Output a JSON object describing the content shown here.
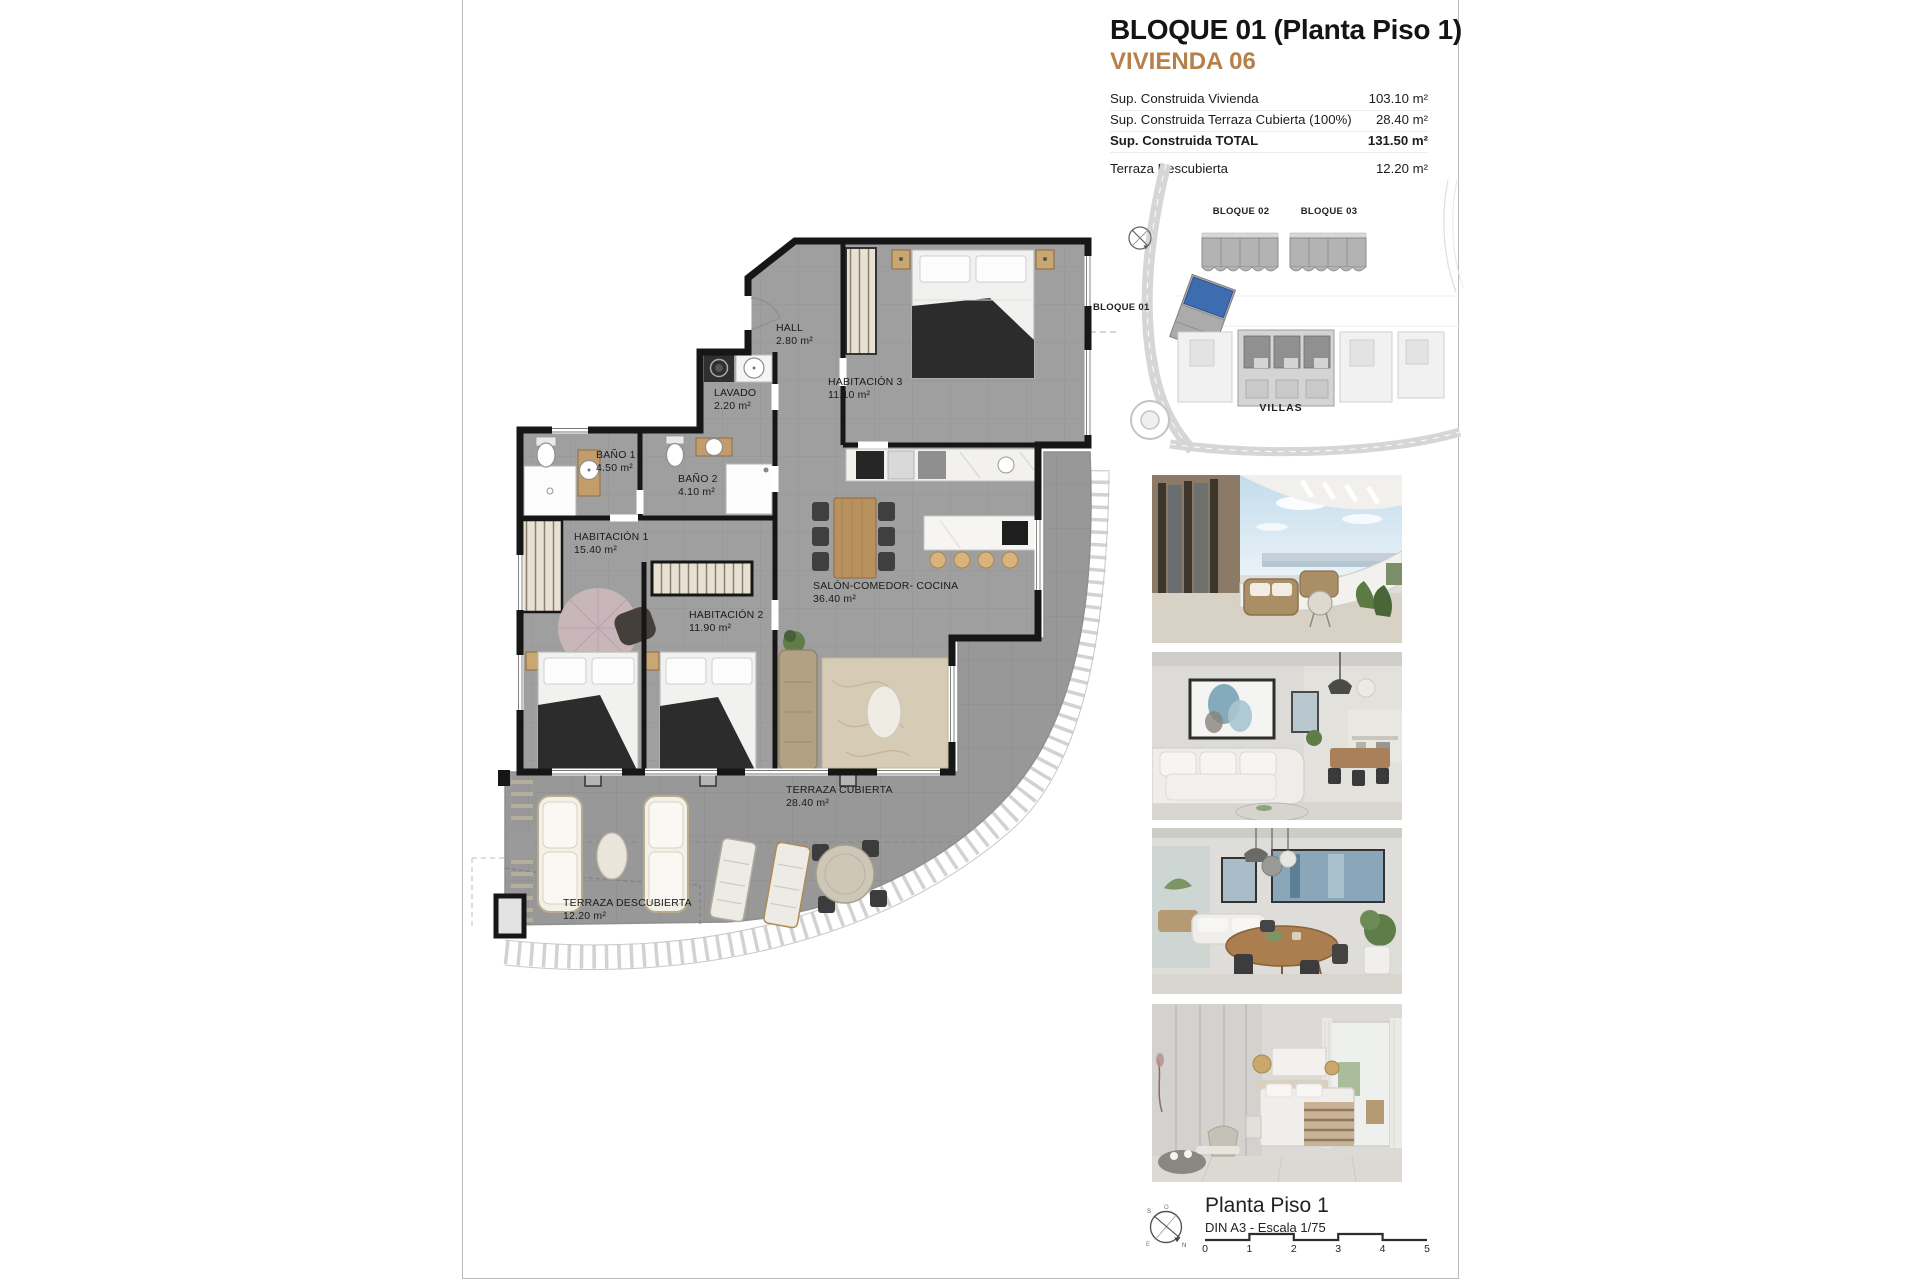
{
  "header": {
    "title": "BLOQUE 01  (Planta Piso 1)",
    "subtitle": "VIVIENDA 06"
  },
  "areas_table": {
    "rows": [
      {
        "label": "Sup. Construida Vivienda",
        "value": "103.10 m²"
      },
      {
        "label": "Sup. Construida Terraza Cubierta (100%)",
        "value": "28.40 m²"
      },
      {
        "label": "Sup. Construida TOTAL",
        "value": "131.50 m²"
      },
      {
        "label": "Terraza Descubierta",
        "value": "12.20 m²"
      }
    ]
  },
  "site_plan": {
    "bloque01_label": "BLOQUE 01",
    "bloque02_label": "BLOQUE 02",
    "bloque03_label": "BLOQUE 03",
    "villas_label": "VILLAS"
  },
  "floor_plan": {
    "rooms": [
      {
        "name": "HALL",
        "area": "2.80 m²"
      },
      {
        "name": "LAVADO",
        "area": "2.20 m²"
      },
      {
        "name": "HABITACIÓN 3",
        "area": "11.10 m²"
      },
      {
        "name": "BAÑO 1",
        "area": "4.50 m²"
      },
      {
        "name": "BAÑO 2",
        "area": "4.10 m²"
      },
      {
        "name": "HABITACIÓN 1",
        "area": "15.40 m²"
      },
      {
        "name": "HABITACIÓN 2",
        "area": "11.90 m²"
      },
      {
        "name": "SALÓN-COMEDOR- COCINA",
        "area": "36.40 m²"
      },
      {
        "name": "TERRAZA CUBIERTA",
        "area": "28.40 m²"
      },
      {
        "name": "TERRAZA DESCUBIERTA",
        "area": "12.20 m²"
      }
    ]
  },
  "photos": {
    "items": [
      "terrace-view",
      "living-room",
      "dining-area",
      "bedroom"
    ]
  },
  "footer": {
    "title": "Planta Piso 1",
    "subtitle": "DIN A3 - Escala 1/75",
    "scale_ticks": [
      "0",
      "1",
      "2",
      "3",
      "4",
      "5"
    ],
    "compass": {
      "n": "N",
      "s": "S",
      "e": "E",
      "o": "O"
    }
  },
  "colors": {
    "accent_orange": "#b5804a",
    "highlight_blue": "#3d6db0",
    "wall_black": "#161616",
    "floor_gray": "#9f9f9f"
  },
  "icons": {
    "site_compass": "compass-icon",
    "footer_compass": "compass-icon"
  }
}
